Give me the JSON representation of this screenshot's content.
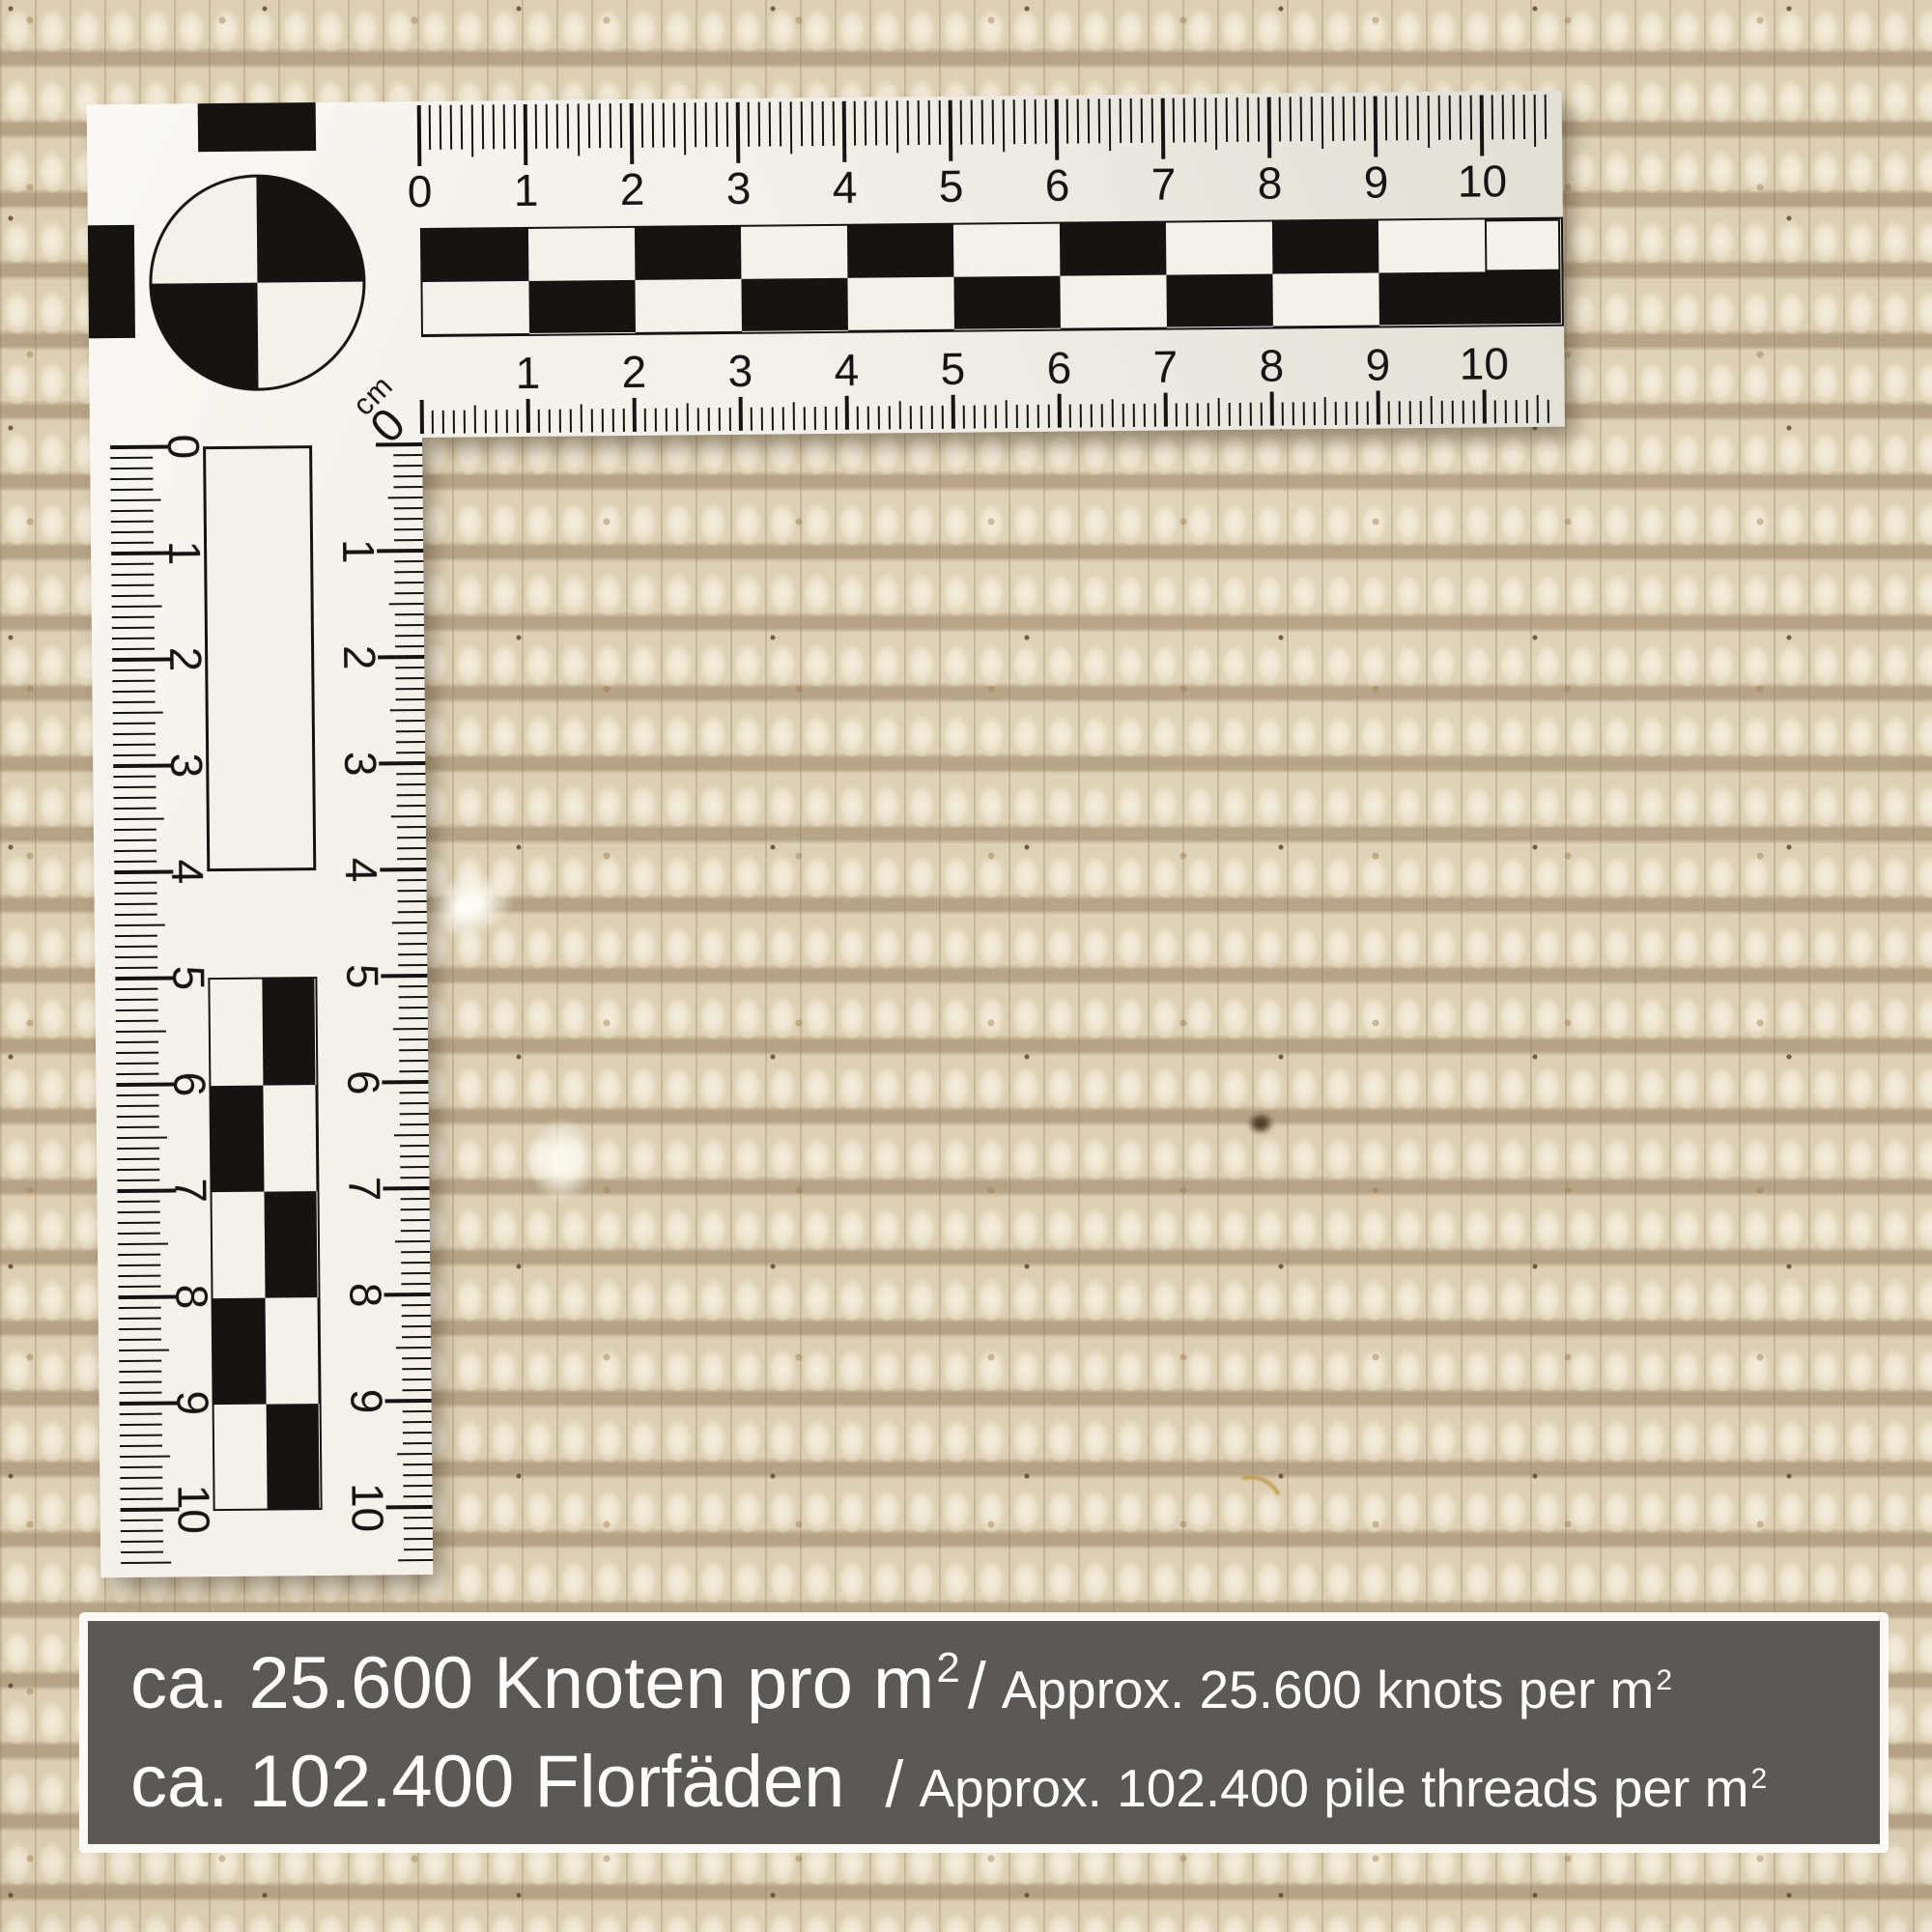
{
  "ruler": {
    "unit_label": "cm",
    "corner_zero": "0",
    "horizontal_top_numbers": [
      "0",
      "1",
      "2",
      "3",
      "4",
      "5",
      "6",
      "7",
      "8",
      "9",
      "10"
    ],
    "horizontal_bottom_numbers": [
      "1",
      "2",
      "3",
      "4",
      "5",
      "6",
      "7",
      "8",
      "9",
      "10"
    ],
    "vertical_left_numbers": [
      "0",
      "1",
      "2",
      "3",
      "4",
      "5",
      "6",
      "7",
      "8",
      "9",
      "10"
    ],
    "vertical_right_numbers": [
      "1",
      "2",
      "3",
      "4",
      "5",
      "6",
      "7",
      "8",
      "9",
      "10"
    ]
  },
  "banner": {
    "line1": {
      "german": "ca. 25.600 Knoten pro m",
      "german_sup": "2",
      "separator": "/",
      "english": "Approx. 25.600 knots per m",
      "english_sup": "2"
    },
    "line2": {
      "german": "ca. 102.400 Florfäden",
      "separator": "/",
      "english": "Approx. 102.400 pile threads per m",
      "english_sup": "2"
    }
  },
  "colors": {
    "carpet_base": "#dccfb4",
    "ruler_paper": "#f3f1ea",
    "ruler_ink": "#161413",
    "banner_background": "#5b5855",
    "banner_border": "#fbfaf7",
    "banner_text": "#ffffff"
  }
}
